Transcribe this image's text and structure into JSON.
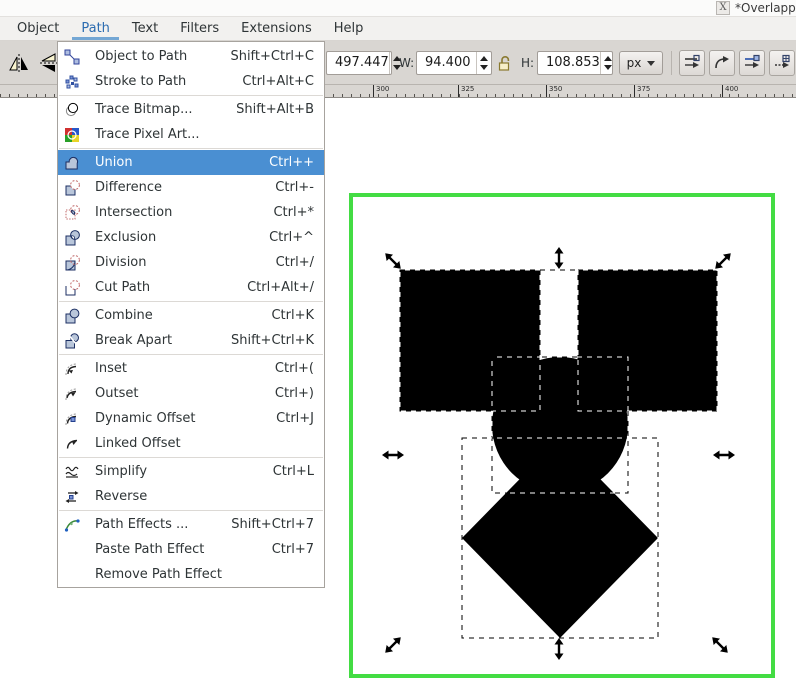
{
  "window": {
    "icon_glyph": "X",
    "title_fragment": "*Overlapp"
  },
  "menubar": {
    "items": [
      {
        "label": "Object"
      },
      {
        "label": "Path"
      },
      {
        "label": "Text"
      },
      {
        "label": "Filters"
      },
      {
        "label": "Extensions"
      },
      {
        "label": "Help"
      }
    ],
    "active_item": "Path",
    "active_text_color": "#2c6cb0",
    "active_underline_color": "#74a7d4"
  },
  "toolbar": {
    "y_field": {
      "value": "497.447"
    },
    "w_field": {
      "label": "W:",
      "value": "94.400"
    },
    "h_field": {
      "label": "H:",
      "value": "108.853"
    },
    "units": {
      "value": "px"
    }
  },
  "ruler": {
    "unit_labels": [
      {
        "text": "200",
        "x": 63
      },
      {
        "text": "300",
        "x": 373
      },
      {
        "text": "325",
        "x": 458
      },
      {
        "text": "350",
        "x": 546
      },
      {
        "text": "375",
        "x": 634
      },
      {
        "text": "400",
        "x": 722
      }
    ]
  },
  "path_menu": {
    "highlight_color": "#4a8fd2",
    "items": [
      {
        "label": "Object to Path",
        "shortcut": "Shift+Ctrl+C"
      },
      {
        "label": "Stroke to Path",
        "shortcut": "Ctrl+Alt+C"
      },
      {
        "label": "Trace Bitmap...",
        "shortcut": "Shift+Alt+B"
      },
      {
        "label": "Trace Pixel Art...",
        "shortcut": ""
      },
      {
        "label": "Union",
        "shortcut": "Ctrl++"
      },
      {
        "label": "Difference",
        "shortcut": "Ctrl+-"
      },
      {
        "label": "Intersection",
        "shortcut": "Ctrl+*"
      },
      {
        "label": "Exclusion",
        "shortcut": "Ctrl+^"
      },
      {
        "label": "Division",
        "shortcut": "Ctrl+/"
      },
      {
        "label": "Cut Path",
        "shortcut": "Ctrl+Alt+/"
      },
      {
        "label": "Combine",
        "shortcut": "Ctrl+K"
      },
      {
        "label": "Break Apart",
        "shortcut": "Shift+Ctrl+K"
      },
      {
        "label": "Inset",
        "shortcut": "Ctrl+("
      },
      {
        "label": "Outset",
        "shortcut": "Ctrl+)"
      },
      {
        "label": "Dynamic Offset",
        "shortcut": "Ctrl+J"
      },
      {
        "label": "Linked Offset",
        "shortcut": ""
      },
      {
        "label": "Simplify",
        "shortcut": "Ctrl+L"
      },
      {
        "label": "Reverse",
        "shortcut": ""
      },
      {
        "label": "Path Effects ...",
        "shortcut": "Shift+Ctrl+7"
      },
      {
        "label": "Paste Path Effect",
        "shortcut": "Ctrl+7"
      },
      {
        "label": "Remove Path Effect",
        "shortcut": ""
      }
    ]
  },
  "canvas": {
    "page_border_color": "#43dc43",
    "shape_color": "#000000"
  }
}
